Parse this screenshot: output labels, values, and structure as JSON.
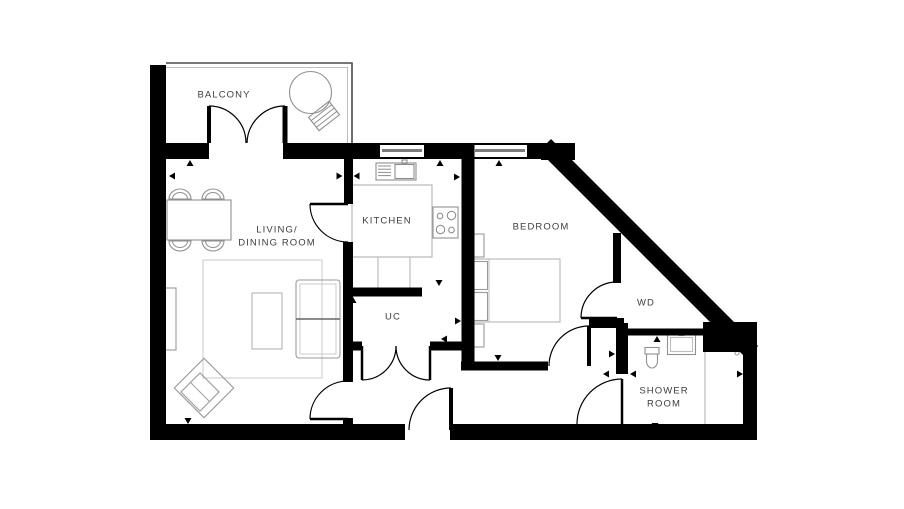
{
  "page": {
    "background": "#ffffff"
  },
  "floorplan": {
    "canvas": {
      "width": 904,
      "height": 509
    },
    "colors": {
      "wall": "#000000",
      "furniture": "#8f8f8f",
      "furniture_light": "#bdbdbd",
      "rug": "#cfcfcf",
      "label": "#3d3d3d",
      "glass": "#7d7d7d",
      "railing": "#4a4a4a",
      "railing_inner": "#bdbdbd"
    },
    "rooms": {
      "balcony": {
        "label": "BALCONY",
        "x": 224,
        "y": 96
      },
      "living": {
        "label": "LIVING/\nDINING ROOM",
        "x": 277,
        "y": 237
      },
      "kitchen": {
        "label": "KITCHEN",
        "x": 387,
        "y": 222
      },
      "bedroom": {
        "label": "BEDROOM",
        "x": 541,
        "y": 228
      },
      "uc": {
        "label": "UC",
        "x": 393,
        "y": 318
      },
      "wd": {
        "label": "WD",
        "x": 646,
        "y": 304
      },
      "shower": {
        "label": "SHOWER\nROOM",
        "x": 664,
        "y": 398
      }
    },
    "balcony_outline": {
      "outer": [
        [
          166,
          63
        ],
        [
          352,
          63
        ],
        [
          352,
          143
        ]
      ],
      "inner": [
        [
          166,
          67.5
        ],
        [
          347.5,
          67.5
        ],
        [
          347.5,
          143
        ]
      ]
    },
    "walls": [
      {
        "x1": 158,
        "y1": 65,
        "x2": 158,
        "y2": 440,
        "w": 16
      },
      {
        "x1": 150,
        "y1": 432,
        "x2": 405,
        "y2": 432,
        "w": 16
      },
      {
        "x1": 450,
        "y1": 432,
        "x2": 757,
        "y2": 432,
        "w": 16
      },
      {
        "x1": 750,
        "y1": 350,
        "x2": 750,
        "y2": 432,
        "w": 14
      },
      {
        "x1": 150,
        "y1": 151,
        "x2": 209,
        "y2": 151,
        "w": 16
      },
      {
        "x1": 283,
        "y1": 151,
        "x2": 380,
        "y2": 151,
        "w": 16
      },
      {
        "x1": 424,
        "y1": 151,
        "x2": 473,
        "y2": 151,
        "w": 16
      },
      {
        "x1": 527,
        "y1": 151,
        "x2": 572,
        "y2": 151,
        "w": 16
      },
      {
        "x1": 551,
        "y1": 151,
        "x2": 746,
        "y2": 346,
        "w": 17,
        "cap": "square"
      },
      {
        "x1": 348.5,
        "y1": 159,
        "x2": 348.5,
        "y2": 204,
        "w": 9
      },
      {
        "x1": 348,
        "y1": 242,
        "x2": 348,
        "y2": 382,
        "w": 10
      },
      {
        "x1": 348,
        "y1": 418,
        "x2": 348,
        "y2": 425,
        "w": 10
      },
      {
        "x1": 345,
        "y1": 292,
        "x2": 422,
        "y2": 292,
        "w": 9
      },
      {
        "x1": 345,
        "y1": 346,
        "x2": 362,
        "y2": 346,
        "w": 9
      },
      {
        "x1": 430,
        "y1": 346,
        "x2": 463,
        "y2": 346,
        "w": 9
      },
      {
        "x1": 468,
        "y1": 145,
        "x2": 468,
        "y2": 366,
        "w": 13
      },
      {
        "x1": 461,
        "y1": 366,
        "x2": 548,
        "y2": 366,
        "w": 9
      },
      {
        "x1": 589,
        "y1": 323,
        "x2": 624,
        "y2": 323,
        "w": 10
      },
      {
        "x1": 622,
        "y1": 323,
        "x2": 622,
        "y2": 374,
        "w": 12
      },
      {
        "x1": 618,
        "y1": 332,
        "x2": 704,
        "y2": 332,
        "w": 7
      },
      {
        "x1": 617,
        "y1": 233,
        "x2": 617,
        "y2": 283,
        "w": 8
      }
    ],
    "wall_rects": [
      {
        "x": 703,
        "y": 322,
        "w": 54,
        "h": 30
      },
      {
        "x": 541,
        "y": 143,
        "w": 34,
        "h": 17
      }
    ],
    "windows": [
      {
        "x": 380,
        "y": 143,
        "w": 44,
        "h": 16
      },
      {
        "x": 473,
        "y": 143,
        "w": 54,
        "h": 16
      }
    ],
    "doors": [
      {
        "name": "balcony-door-left",
        "leaf": [
          209,
          143,
          209,
          106
        ],
        "arc": {
          "from": [
            209,
            106
          ],
          "to": [
            246,
            143
          ],
          "r": 37,
          "sweep": 1
        },
        "lw": 4
      },
      {
        "name": "balcony-door-right",
        "leaf": [
          285,
          143,
          285,
          106
        ],
        "arc": {
          "from": [
            285,
            106
          ],
          "to": [
            247,
            143
          ],
          "r": 38,
          "sweep": 0
        },
        "lw": 5
      },
      {
        "name": "kitchen-door",
        "leaf": [
          348,
          204,
          310,
          204
        ],
        "arc": {
          "from": [
            310,
            204
          ],
          "to": [
            348,
            242
          ],
          "r": 38,
          "sweep": 0
        },
        "lw": 2.5
      },
      {
        "name": "uc-door-left",
        "leaf": [
          362,
          346,
          362,
          380
        ],
        "arc": {
          "from": [
            362,
            380
          ],
          "to": [
            396,
            346
          ],
          "r": 34,
          "sweep": 0
        },
        "lw": 2.5
      },
      {
        "name": "uc-door-right",
        "leaf": [
          430,
          346,
          430,
          380
        ],
        "arc": {
          "from": [
            430,
            380
          ],
          "to": [
            396,
            346
          ],
          "r": 34,
          "sweep": 1
        },
        "lw": 2.5
      },
      {
        "name": "living-door",
        "leaf": [
          348,
          419,
          310,
          419
        ],
        "arc": {
          "from": [
            310,
            419
          ],
          "to": [
            348,
            381
          ],
          "r": 38,
          "sweep": 1
        },
        "lw": 2.5
      },
      {
        "name": "entrance-door",
        "leaf": [
          451,
          430,
          451,
          388
        ],
        "arc": {
          "from": [
            451,
            388
          ],
          "to": [
            409,
            430
          ],
          "r": 42,
          "sweep": 0
        },
        "lw": 4
      },
      {
        "name": "bedroom-door",
        "leaf": [
          589,
          366,
          589,
          326
        ],
        "arc": {
          "from": [
            589,
            326
          ],
          "to": [
            549,
            366
          ],
          "r": 40,
          "sweep": 0
        },
        "lw": 4
      },
      {
        "name": "wd-door",
        "leaf": [
          617,
          318,
          581,
          318
        ],
        "arc": {
          "from": [
            581,
            318
          ],
          "to": [
            617,
            282
          ],
          "r": 36,
          "sweep": 1
        },
        "lw": 2.5
      },
      {
        "name": "shower-door",
        "leaf": [
          622,
          424,
          622,
          379
        ],
        "arc": {
          "from": [
            622,
            379
          ],
          "to": [
            577,
            424
          ],
          "r": 45,
          "sweep": 0
        },
        "lw": 2.5
      }
    ],
    "furniture": [
      {
        "kind": "circle",
        "name": "balcony-table",
        "cx": 310.5,
        "cy": 92.5,
        "r": 21,
        "s": "#8f8f8f"
      },
      {
        "kind": "rotrect",
        "name": "balcony-chair",
        "cx": 324,
        "cy": 116,
        "w": 26,
        "h": 17,
        "angle": -38,
        "slats": 3,
        "s": "#8f8f8f"
      },
      {
        "kind": "rect",
        "name": "dining-table",
        "x": 167,
        "y": 200,
        "w": 64,
        "h": 40,
        "s": "#8f8f8f"
      },
      {
        "kind": "chair",
        "name": "dining-chair",
        "cx": 180,
        "cy": 199,
        "dir": "up"
      },
      {
        "kind": "chair",
        "name": "dining-chair",
        "cx": 213,
        "cy": 199,
        "dir": "up"
      },
      {
        "kind": "chair",
        "name": "dining-chair",
        "cx": 180,
        "cy": 241,
        "dir": "down"
      },
      {
        "kind": "chair",
        "name": "dining-chair",
        "cx": 213,
        "cy": 241,
        "dir": "down"
      },
      {
        "kind": "rect",
        "name": "rug",
        "x": 203,
        "y": 260,
        "w": 119,
        "h": 118,
        "s": "#cfcfcf"
      },
      {
        "kind": "rect",
        "name": "coffee-table",
        "x": 252,
        "y": 293,
        "w": 30,
        "h": 56,
        "s": "#b5b5b5"
      },
      {
        "kind": "rect",
        "name": "sofa",
        "x": 296,
        "y": 280,
        "w": 44,
        "h": 78,
        "s": "#9a9a9a",
        "rx": 3
      },
      {
        "kind": "rect",
        "name": "sofa-cushions",
        "x": 300,
        "y": 284,
        "w": 36,
        "h": 70,
        "s": "#cfcfcf"
      },
      {
        "kind": "line",
        "name": "sofa-divider",
        "x1": 296,
        "y1": 319,
        "x2": 340,
        "y2": 319,
        "s": "#666666",
        "w": 1.4
      },
      {
        "kind": "rect",
        "name": "sideboard",
        "x": 163,
        "y": 288,
        "w": 13,
        "h": 62,
        "s": "#9a9a9a"
      },
      {
        "kind": "rotrect",
        "name": "armchair",
        "cx": 204,
        "cy": 388,
        "w": 42,
        "h": 42,
        "angle": 45,
        "slats": 0,
        "s": "#9a9a9a"
      },
      {
        "kind": "rotrect",
        "name": "armchair-seat",
        "cx": 200,
        "cy": 392,
        "w": 27,
        "h": 27,
        "angle": 45,
        "slats": 1,
        "s": "#9a9a9a"
      },
      {
        "kind": "rect",
        "name": "kitchen-sink-unit",
        "x": 376,
        "y": 163,
        "w": 40,
        "h": 17,
        "s": "#8f8f8f"
      },
      {
        "kind": "hatch",
        "name": "sink-drainer",
        "x": 378,
        "y": 166,
        "w": 13,
        "n": 4,
        "gap": 3.2,
        "s": "#8f8f8f"
      },
      {
        "kind": "rect",
        "name": "sink-basin",
        "x": 395,
        "y": 164.5,
        "w": 19,
        "h": 14,
        "s": "#8f8f8f"
      },
      {
        "kind": "rect",
        "name": "sink-tap",
        "x": 402,
        "y": 160,
        "w": 5,
        "h": 4,
        "s": "#8f8f8f"
      },
      {
        "kind": "rect",
        "name": "kitchen-counter",
        "x": 352,
        "y": 185,
        "w": 80,
        "h": 72,
        "s": "#b0b0b0"
      },
      {
        "kind": "line",
        "name": "kitchen-unit-divider",
        "x1": 378,
        "y1": 257,
        "x2": 378,
        "y2": 288,
        "s": "#b0b0b0",
        "w": 1
      },
      {
        "kind": "line",
        "name": "kitchen-unit-divider",
        "x1": 410,
        "y1": 257,
        "x2": 410,
        "y2": 288,
        "s": "#b0b0b0",
        "w": 1
      },
      {
        "kind": "rect",
        "name": "hob",
        "x": 433,
        "y": 207,
        "w": 25,
        "h": 31,
        "s": "#8f8f8f"
      },
      {
        "kind": "circle",
        "name": "hob-burner",
        "cx": 440,
        "cy": 216,
        "r": 2.8,
        "s": "#8f8f8f"
      },
      {
        "kind": "circle",
        "name": "hob-burner",
        "cx": 451.5,
        "cy": 215.5,
        "r": 4.2,
        "s": "#8f8f8f"
      },
      {
        "kind": "circle",
        "name": "hob-burner",
        "cx": 440.5,
        "cy": 229.5,
        "r": 4.2,
        "s": "#8f8f8f"
      },
      {
        "kind": "circle",
        "name": "hob-burner",
        "cx": 451.5,
        "cy": 230,
        "r": 2.8,
        "s": "#8f8f8f"
      },
      {
        "kind": "rect",
        "name": "bed",
        "x": 467,
        "y": 259,
        "w": 93,
        "h": 63,
        "s": "#b5b5b5"
      },
      {
        "kind": "rect",
        "name": "pillow",
        "x": 469.5,
        "y": 261.5,
        "w": 18,
        "h": 28,
        "s": "#9a9a9a"
      },
      {
        "kind": "rect",
        "name": "pillow",
        "x": 469.5,
        "y": 292.5,
        "w": 18,
        "h": 28,
        "s": "#9a9a9a"
      },
      {
        "kind": "line",
        "name": "bed-headboard",
        "x1": 489,
        "y1": 259,
        "x2": 489,
        "y2": 322,
        "s": "#c0c0c0",
        "w": 1
      },
      {
        "kind": "rect",
        "name": "bedside-table",
        "x": 471,
        "y": 234,
        "w": 13,
        "h": 23,
        "s": "#9a9a9a"
      },
      {
        "kind": "rect",
        "name": "bedside-table",
        "x": 471,
        "y": 324,
        "w": 13,
        "h": 23,
        "s": "#9a9a9a"
      },
      {
        "kind": "rect",
        "name": "toilet-cistern",
        "x": 645,
        "y": 347.5,
        "w": 14,
        "h": 6.5,
        "s": "#8f8f8f"
      },
      {
        "kind": "path",
        "name": "toilet-bowl",
        "d": "M646.5,354 h11 v7 a5.5,7 0 0 1 -11,0 Z",
        "s": "#8f8f8f"
      },
      {
        "kind": "rect",
        "name": "bathroom-basin",
        "x": 667.5,
        "y": 334.5,
        "w": 28,
        "h": 20,
        "s": "#8f8f8f"
      },
      {
        "kind": "rect",
        "name": "bathroom-basin-inner",
        "x": 670.5,
        "y": 337.5,
        "w": 22,
        "h": 14,
        "s": "#bdbdbd"
      },
      {
        "kind": "rect",
        "name": "basin-tap",
        "x": 679,
        "y": 331.5,
        "w": 5,
        "h": 4,
        "s": "#8f8f8f"
      },
      {
        "kind": "rect",
        "name": "shower-tray",
        "x": 705,
        "y": 348,
        "w": 40,
        "h": 80,
        "s": "#b5b5b5"
      },
      {
        "kind": "circle",
        "name": "shower-drain",
        "cx": 737,
        "cy": 353,
        "r": 2,
        "s": "#9a9a9a"
      }
    ],
    "arrows": [
      {
        "x": 190,
        "y": 160,
        "dir": "up"
      },
      {
        "x": 169,
        "y": 176,
        "dir": "left"
      },
      {
        "x": 342.5,
        "y": 176,
        "dir": "right"
      },
      {
        "x": 353.5,
        "y": 176,
        "dir": "left"
      },
      {
        "x": 440,
        "y": 160,
        "dir": "up"
      },
      {
        "x": 460,
        "y": 177,
        "dir": "right"
      },
      {
        "x": 439,
        "y": 286,
        "dir": "down"
      },
      {
        "x": 353,
        "y": 297,
        "dir": "up"
      },
      {
        "x": 499,
        "y": 160,
        "dir": "up"
      },
      {
        "x": 461,
        "y": 321,
        "dir": "right"
      },
      {
        "x": 441,
        "y": 339,
        "dir": "left"
      },
      {
        "x": 498,
        "y": 361,
        "dir": "down"
      },
      {
        "x": 615,
        "y": 354,
        "dir": "right"
      },
      {
        "x": 630,
        "y": 374,
        "dir": "left"
      },
      {
        "x": 603,
        "y": 374,
        "dir": "left"
      },
      {
        "x": 657,
        "y": 336,
        "dir": "up"
      },
      {
        "x": 655,
        "y": 429,
        "dir": "down"
      },
      {
        "x": 743,
        "y": 374,
        "dir": "right"
      },
      {
        "x": 188,
        "y": 424,
        "dir": "down"
      }
    ]
  }
}
